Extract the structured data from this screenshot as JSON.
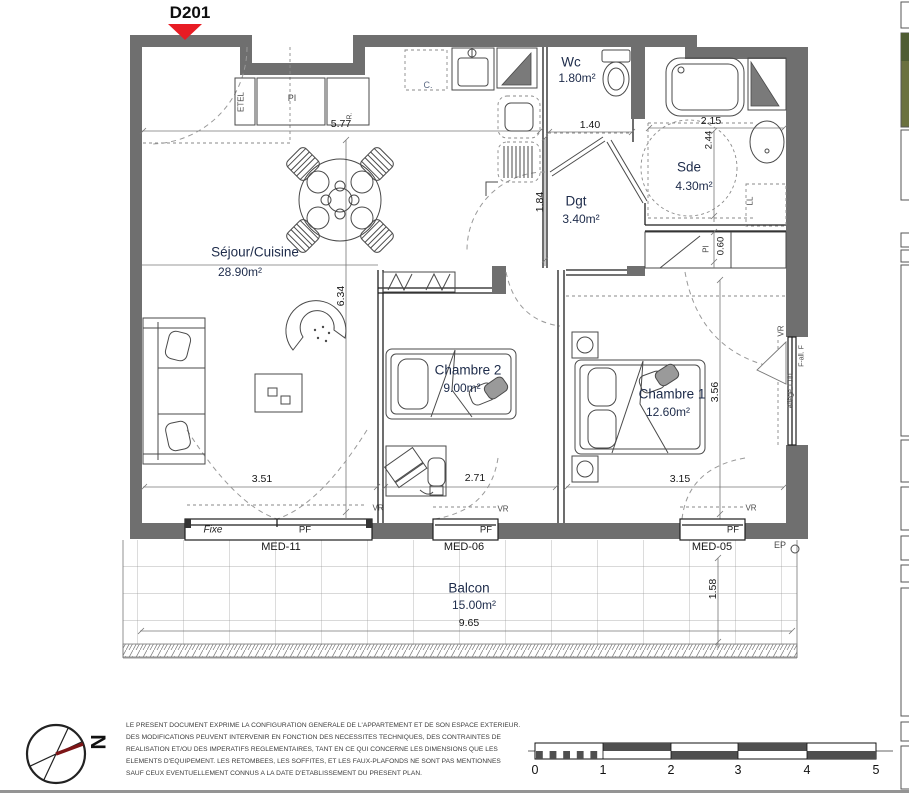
{
  "plan": {
    "unit_label": "D201",
    "rooms": {
      "sejour": {
        "name": "Séjour/Cuisine",
        "area": "28.90m²"
      },
      "wc": {
        "name": "Wc",
        "area": "1.80m²"
      },
      "dgt": {
        "name": "Dgt",
        "area": "3.40m²"
      },
      "sde": {
        "name": "Sde",
        "area": "4.30m²"
      },
      "chambre2": {
        "name": "Chambre 2",
        "area": "9.00m²"
      },
      "chambre1": {
        "name": "Chambre 1",
        "area": "12.60m²"
      },
      "balcon": {
        "name": "Balcon",
        "area": "15.00m²"
      }
    },
    "dims": {
      "d577": "5.77",
      "d140": "1.40",
      "d184": "1.84",
      "d215": "2.15",
      "d244": "2.44",
      "d060": "0.60",
      "d634": "6.34",
      "d351": "3.51",
      "d271": "2.71",
      "d315": "3.15",
      "d356": "3.56",
      "d965": "9.65",
      "d158": "1.58",
      "allege": "Allège 1.00"
    },
    "tags": {
      "etel": "ETEL",
      "pi_entry": "PI",
      "r_tag": "R.",
      "c_tag": "C.",
      "ll": "LL",
      "pi_dgt": "PI",
      "vr_a": "VR",
      "vr_b": "VR",
      "vr_c": "VR",
      "vr_wall": "VR",
      "ep": "EP",
      "fall": "F-all. F"
    },
    "windows": {
      "w1": {
        "left_label": "Fixe",
        "right_label": "PF",
        "code": "MED-11"
      },
      "w2": {
        "right_label": "PF",
        "code": "MED-06"
      },
      "w3": {
        "right_label": "PF",
        "code": "MED-05"
      }
    },
    "colors": {
      "wall": "#6f6f6f",
      "arrow_red": "#e81c24",
      "compass_red": "#7d1517"
    }
  },
  "footer": {
    "north_letter": "N",
    "scale_ticks": [
      "0",
      "1",
      "2",
      "3",
      "4",
      "5"
    ],
    "disclaimer_lines": [
      "LE PRESENT DOCUMENT EXPRIME LA CONFIGURATION GENERALE DE L'APPARTEMENT ET DE SON ESPACE EXTERIEUR.",
      "DES MODIFICATIONS PEUVENT INTERVENIR EN FONCTION DES NECESSITES TECHNIQUES, DES CONTRAINTES DE",
      "REALISATION ET/OU DES IMPERATIFS REGLEMENTAIRES, TANT EN CE QUI CONCERNE LES DIMENSIONS QUE LES",
      "ELEMENTS D'EQUIPEMENT. LES RETOMBEES, LES SOFFITES, ET LES FAUX-PLAFONDS NE SONT PAS MENTIONNES",
      "SAUF CEUX EVENTUELLEMENT CONNUS A LA DATE D'ETABLISSEMENT DU PRESENT PLAN."
    ]
  }
}
